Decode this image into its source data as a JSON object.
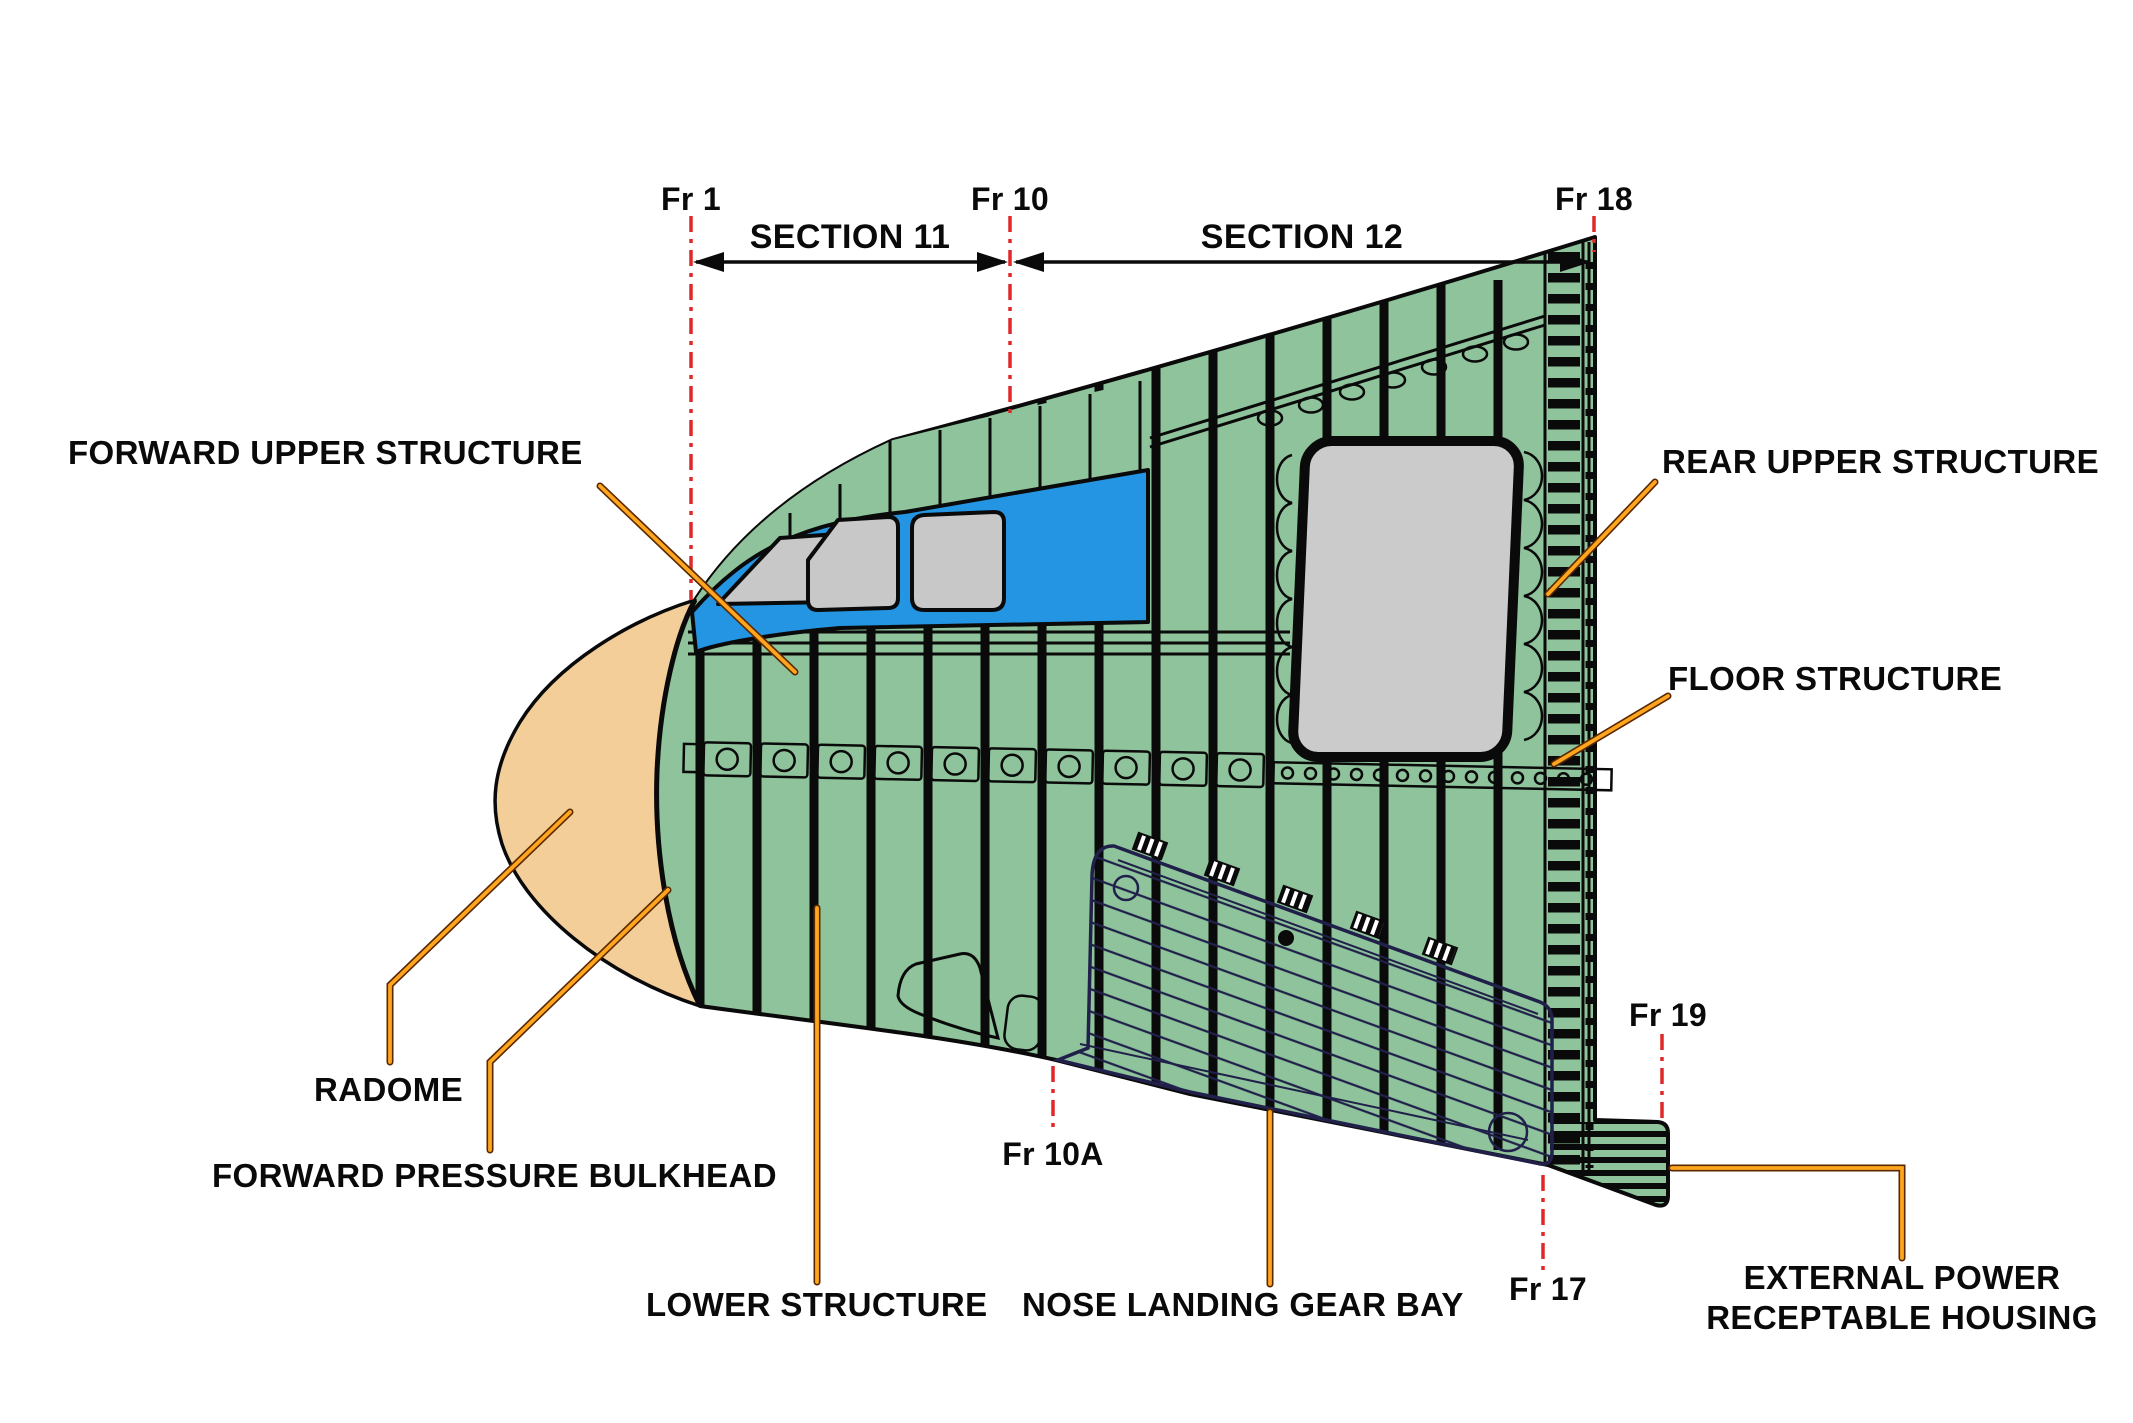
{
  "section_markers": {
    "fr1": "Fr 1",
    "fr10": "Fr 10",
    "fr18": "Fr 18",
    "section11": "SECTION 11",
    "section12": "SECTION 12"
  },
  "frame_markers": {
    "fr10a": "Fr 10A",
    "fr17": "Fr 17",
    "fr19": "Fr 19"
  },
  "part_labels": {
    "forward_upper_structure": "FORWARD UPPER STRUCTURE",
    "rear_upper_structure": "REAR UPPER STRUCTURE",
    "floor_structure": "FLOOR STRUCTURE",
    "radome": "RADOME",
    "forward_pressure_bulkhead": "FORWARD PRESSURE BULKHEAD",
    "lower_structure": "LOWER STRUCTURE",
    "nose_landing_gear_bay": "NOSE LANDING GEAR BAY",
    "external_power_line1": "EXTERNAL POWER",
    "external_power_line2": "RECEPTABLE HOUSING"
  },
  "colors": {
    "structure_green": "#8ec39b",
    "radome_tan": "#f3ce98",
    "window_floor_blue": "#2395e3",
    "window_gray": "#c8c8c8",
    "door_gray": "#cbcbcb",
    "gear_bay_lavender": "#a7a6d2",
    "gear_bay_line": "#20204a",
    "teal_accent": "#108068",
    "leader_orange": "#ffa51e",
    "frame_marker_red": "#e02828",
    "text_black": "#0a0a0a"
  }
}
